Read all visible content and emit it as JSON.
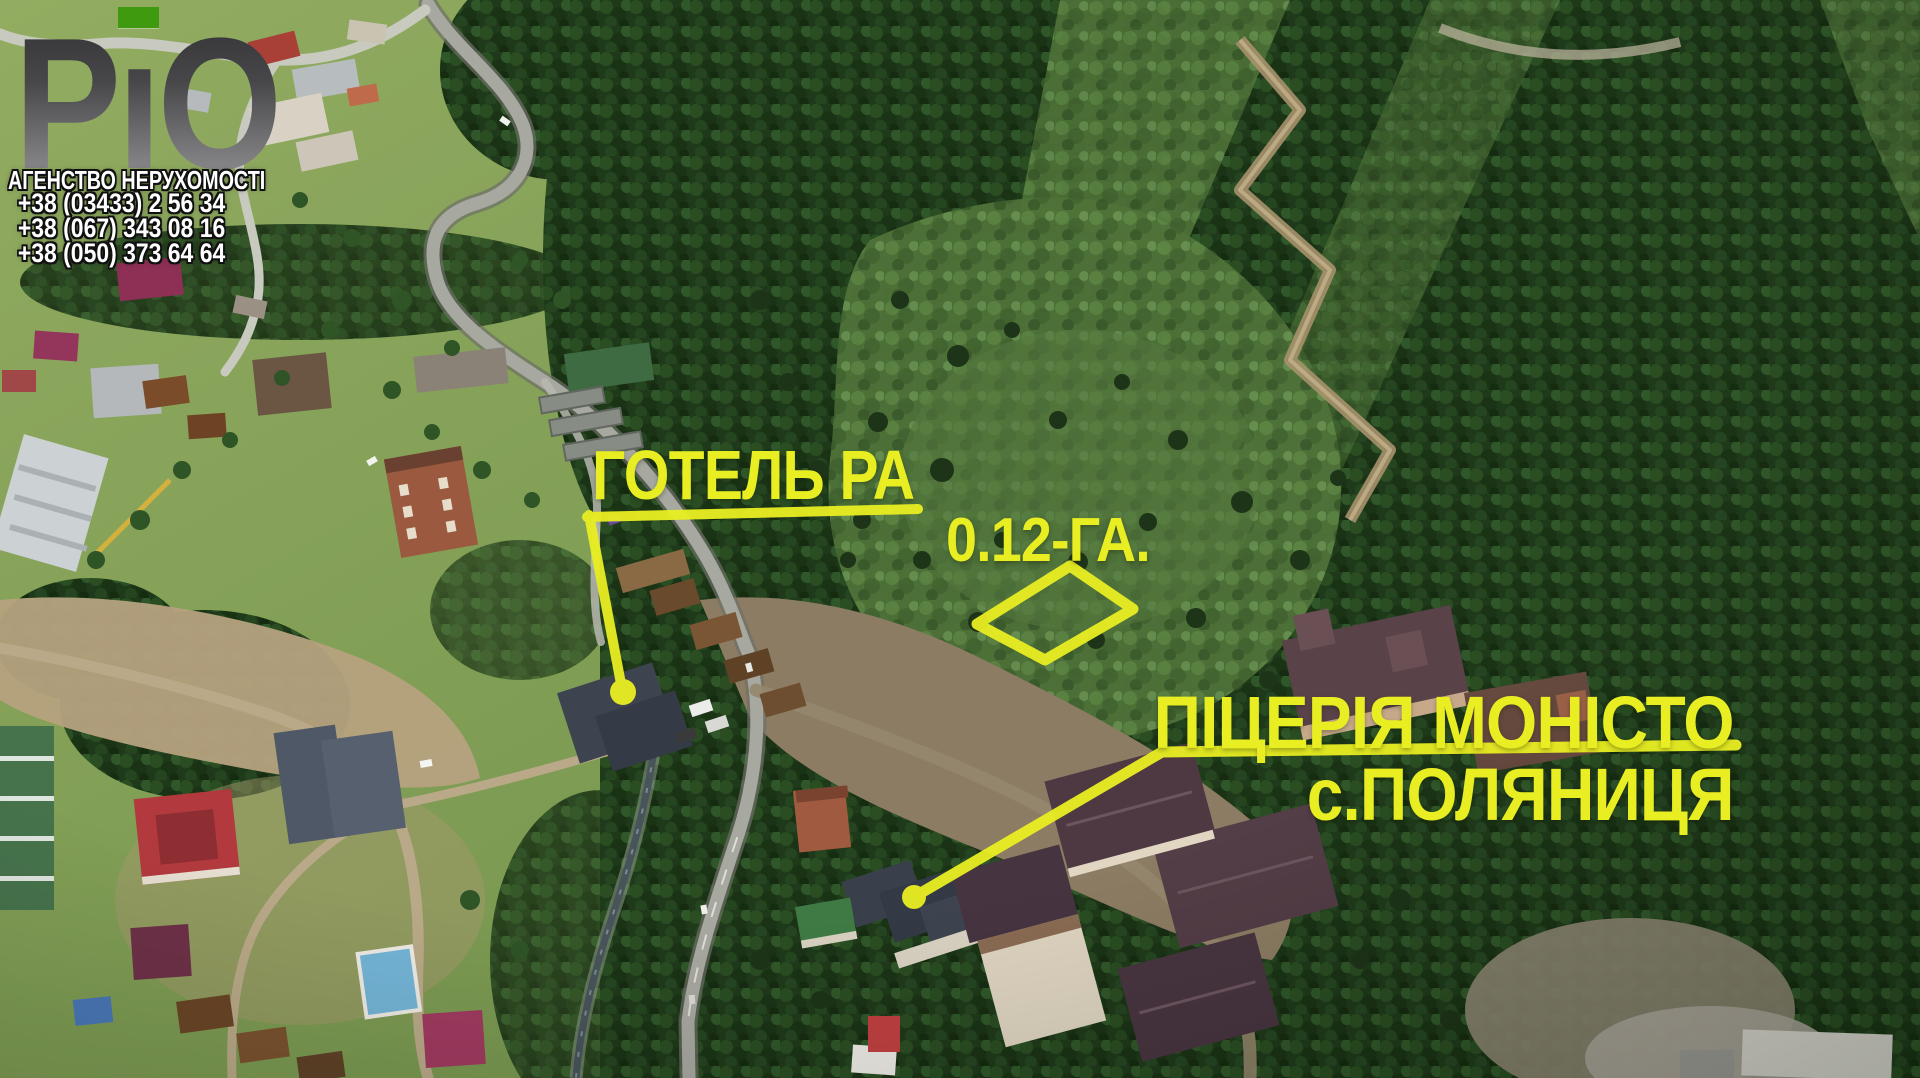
{
  "agency": {
    "logo_parts": [
      "Р",
      "ı",
      "О"
    ],
    "name_line": "АГЕНСТВО НЕРУХОМОСТІ",
    "phones": [
      "+38 (03433) 2 56 34",
      "+38 (067) 343 08 16",
      "+38 (050) 373 64 64"
    ]
  },
  "labels": {
    "hotel": "ГОТЕЛЬ РА",
    "plot_area": "0.12-ГА.",
    "pizzeria": "ПІЦЕРІЯ МОНІСТО",
    "village": "с.ПОЛЯНИЦЯ"
  },
  "colors": {
    "annotation_yellow": "#e9ee22",
    "logo_green": "#3f9a10"
  }
}
